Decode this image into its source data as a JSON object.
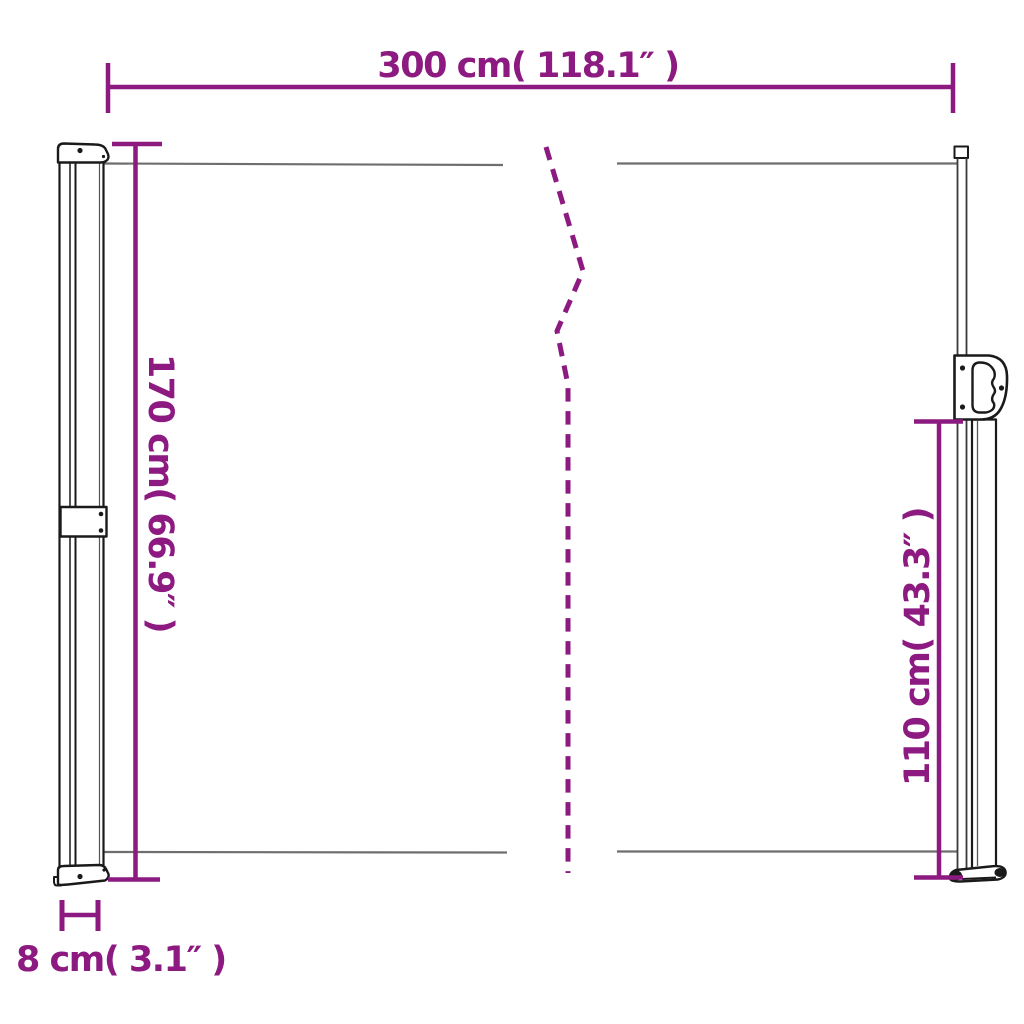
{
  "colors": {
    "dimension": "#8C1A80",
    "outline": "#1A1A1A",
    "fabric": "#6E6E6E",
    "background": "#FFFFFF"
  },
  "labels": {
    "width_top": "300 cm( 118.1″ )",
    "height_left": "170 cm( 66.9″ )",
    "height_right": "110 cm( 43.3″ )",
    "depth_bottom": "8 cm( 3.1″ )"
  },
  "measurements": {
    "width_top": {
      "cm": 300,
      "inches": 118.1
    },
    "height_left": {
      "cm": 170,
      "inches": 66.9
    },
    "height_right": {
      "cm": 110,
      "inches": 43.3
    },
    "depth_bottom": {
      "cm": 8,
      "inches": 3.1
    }
  }
}
